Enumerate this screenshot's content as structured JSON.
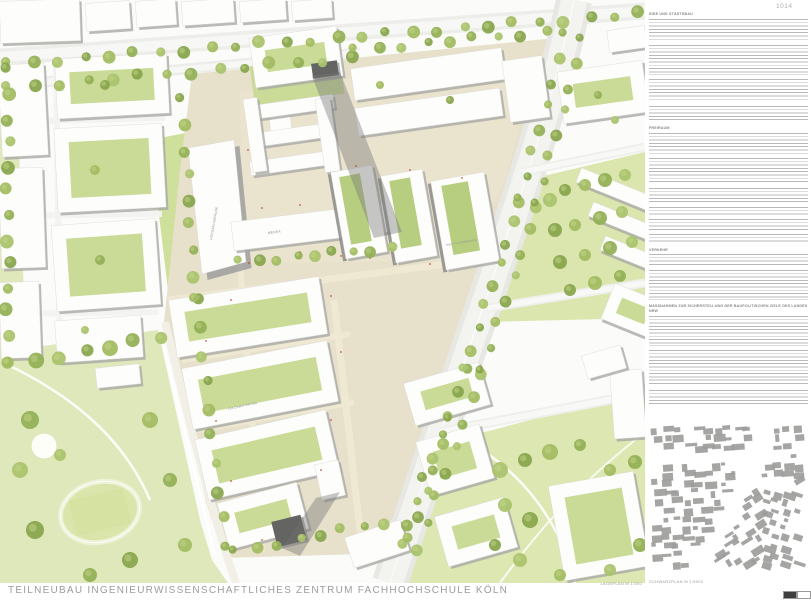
{
  "page": {
    "number": "1014"
  },
  "board": {
    "title": "TEILNEUBAU INGENIEURWISSENSCHAFTLICHES ZENTRUM FACHHOCHSCHULE KÖLN"
  },
  "plan": {
    "caption": "LAGEPLAN M 1:500",
    "labels": {
      "hoersaalgebaeude": "HÖRSAALGEBÄUDE",
      "mensa": "MENSA",
      "institutsgebaeude": "INSTITUTSGEBÄUDE",
      "tba_erweiterung": "TBA ERWEITERUNG"
    }
  },
  "text_column": {
    "sections": [
      {
        "heading": "IDEE UND STÄDTEBAU"
      },
      {
        "heading": "FREIRAUM"
      },
      {
        "heading": "VERKEHR"
      },
      {
        "heading": "MASSNAHMEN ZUR SICHERSTELLUNG DER BAUPOLITISCHEN ZIELE DES LANDES NRW"
      }
    ]
  },
  "keyplan": {
    "caption": "SCHWARZPLAN M 1:5000"
  },
  "colors": {
    "tree_green": "#9cb85e",
    "lawn_green": "#dfe8ba",
    "campus_beige": "#e7e0cb",
    "building_white": "#fdfdfc",
    "shadow_gray": "#8b8b88",
    "text_gray": "#9a9a9a"
  }
}
